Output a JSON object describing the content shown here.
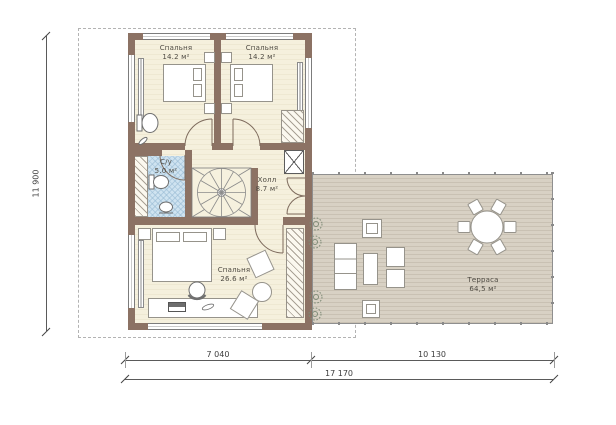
{
  "rooms": {
    "bedroom_tl": {
      "name": "Спальня",
      "area": "14.2 м²"
    },
    "bedroom_tr": {
      "name": "Спальня",
      "area": "14.2 м²"
    },
    "bathroom": {
      "name": "С/у",
      "area": "5.0 м²"
    },
    "hall": {
      "name": "Холл",
      "area": "8.7 м²"
    },
    "bedroom_big": {
      "name": "Спальня",
      "area": "26.6 м²"
    },
    "terrace": {
      "name": "Терраса",
      "area": "64,5 м²"
    }
  },
  "dimensions": {
    "height_total": "11 900",
    "width_left": "7 040",
    "width_right": "10 130",
    "width_total": "17 170"
  },
  "colors": {
    "wall": "#8c7264",
    "floor": "#f4efdc",
    "bathroom_tile": "#cfe3f0",
    "terrace_deck": "#d8d1c4",
    "boundary_dash": "#b3b3b3",
    "dimension": "#5a5a5a"
  }
}
